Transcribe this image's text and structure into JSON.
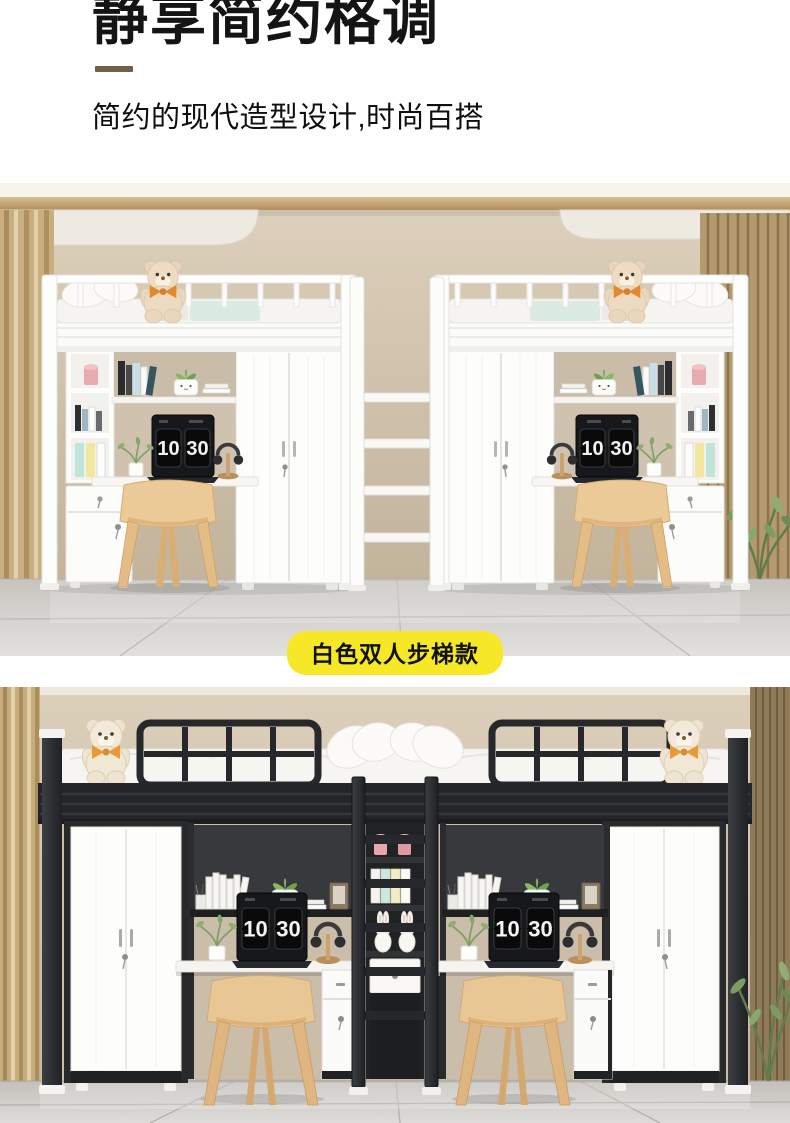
{
  "header": {
    "title": "静享简约格调",
    "subtitle": "简约的现代造型设计,时尚百搭",
    "accent_color": "#6f6148"
  },
  "photo_white": {
    "badge_label": "白色双人步梯款",
    "badge_color": "#F6E827",
    "clock_left": {
      "hour": "10",
      "minute": "30"
    },
    "clock_right": {
      "hour": "10",
      "minute": "30"
    }
  },
  "photo_black": {
    "clock_left": {
      "hour": "10",
      "minute": "30"
    },
    "clock_right": {
      "hour": "10",
      "minute": "30"
    }
  }
}
